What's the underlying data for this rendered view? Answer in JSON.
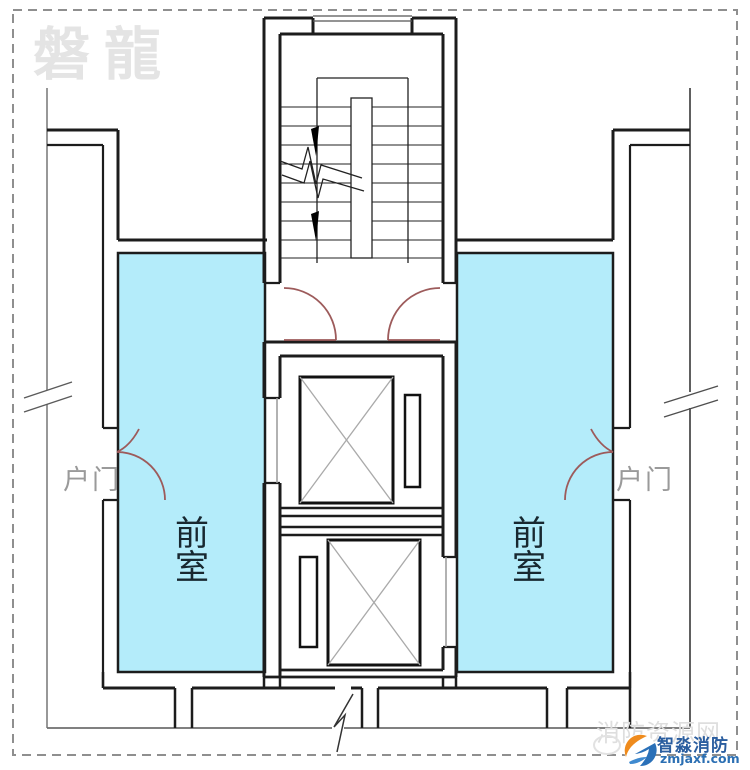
{
  "page": {
    "background": "#ffffff",
    "border_color": "#8f8f8f"
  },
  "watermark": {
    "text": "磐龍",
    "color": "#e4e4e4"
  },
  "plan": {
    "fill_color": "#b4ecfa",
    "wall_color": "#1c1c1c",
    "door_color": "#9d5b5b",
    "room_label_left": {
      "char1": "前",
      "char2": "室"
    },
    "room_label_right": {
      "char1": "前",
      "char2": "室"
    },
    "door_label_left": "户门",
    "door_label_right": "户门"
  },
  "logo": {
    "brand": "智淼消防",
    "domain": "zmjaxf.com",
    "ghost_text": "消防资源网",
    "orange": "#ef8b1d",
    "blue": "#2a70b8"
  }
}
